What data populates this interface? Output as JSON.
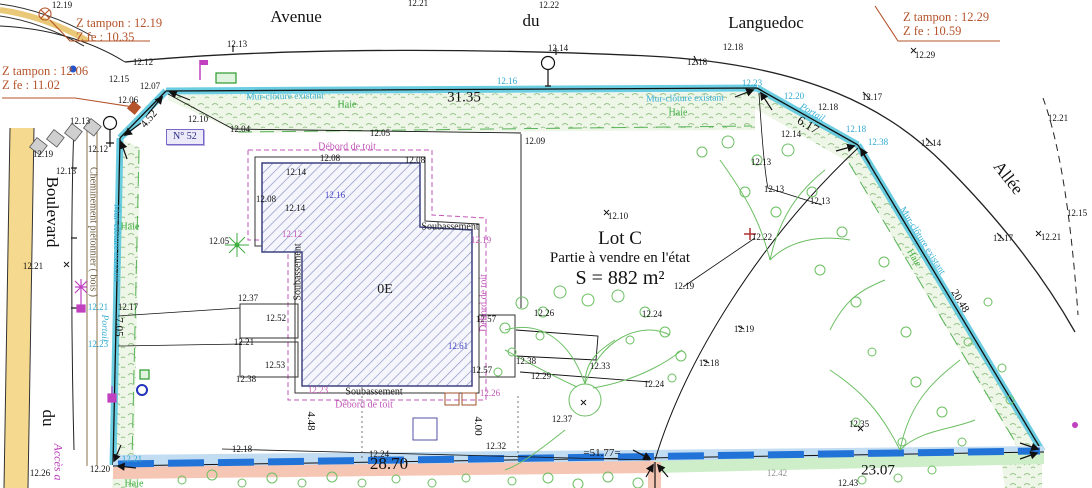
{
  "colors": {
    "boundary_cyan": "#4fc4dc",
    "hedge_green": "#57b357",
    "veg_green": "#6cbf63",
    "roof_magenta": "#c257b8",
    "note_orange": "#b5532a",
    "parcel_blue_dash": "#2273d8",
    "salmon_band": "#f6c6b4",
    "green_band": "#cdeec8",
    "hatch_blue": "#3c4280",
    "walk_tan": "#f0d080"
  },
  "z_notes": [
    {
      "line1": "Z tampon : 12.19",
      "line2": "Z fe : 10.35"
    },
    {
      "line1": "Z tampon : 12.06",
      "line2": "Z fe : 11.02"
    },
    {
      "line1": "Z tampon : 12.29",
      "line2": "Z fe : 10.59"
    }
  ],
  "streets": {
    "avenue": "Avenue",
    "du_top": "du",
    "languedoc": "Languedoc",
    "boulevard": "Boulevard",
    "du_left": "du",
    "allee": "Allée",
    "acces": "Accès a"
  },
  "lot": {
    "name": "Lot C",
    "desc": "Partie à vendre en l'état",
    "area": "S = 882 m²",
    "floor": "0E",
    "house_no": "N° 52"
  },
  "labels": [
    {
      "t": "12.19",
      "x": 62,
      "y": 5,
      "c": "spot"
    },
    {
      "t": "12.21",
      "x": 418,
      "y": 3,
      "c": "spot"
    },
    {
      "t": "12.22",
      "x": 549,
      "y": 5,
      "c": "spot"
    },
    {
      "t": "12.29",
      "x": 925,
      "y": 55,
      "c": "spot"
    },
    {
      "t": "12.13",
      "x": 237,
      "y": 44,
      "c": "spot"
    },
    {
      "t": "12.14",
      "x": 558,
      "y": 48,
      "c": "spot"
    },
    {
      "t": "12.18",
      "x": 733,
      "y": 47,
      "c": "spot"
    },
    {
      "t": "12.18",
      "x": 697,
      "y": 62,
      "c": "spot"
    },
    {
      "t": "12.17",
      "x": 872,
      "y": 97,
      "c": "spot"
    },
    {
      "t": "12.12",
      "x": 143,
      "y": 62,
      "c": "spot"
    },
    {
      "t": "12.15",
      "x": 119,
      "y": 79,
      "c": "spot"
    },
    {
      "t": "12.07",
      "x": 150,
      "y": 86,
      "c": "spot"
    },
    {
      "t": "12.06",
      "x": 128,
      "y": 100,
      "c": "spot"
    },
    {
      "t": "12.13",
      "x": 80,
      "y": 121,
      "c": "spot"
    },
    {
      "t": "12.12",
      "x": 98,
      "y": 149,
      "c": "spot"
    },
    {
      "t": "12.19",
      "x": 43,
      "y": 154,
      "c": "spot"
    },
    {
      "t": "12.13",
      "x": 66,
      "y": 171,
      "c": "spot"
    },
    {
      "t": "12.10",
      "x": 198,
      "y": 119,
      "c": "spot"
    },
    {
      "t": "12.04",
      "x": 240,
      "y": 129,
      "c": "spot"
    },
    {
      "t": "12.05",
      "x": 380,
      "y": 133,
      "c": "spot"
    },
    {
      "t": "12.09",
      "x": 535,
      "y": 141,
      "c": "spot"
    },
    {
      "t": "12.16",
      "x": 507,
      "y": 81,
      "c": "spot-cyan"
    },
    {
      "t": "12.23",
      "x": 752,
      "y": 83,
      "c": "spot-cyan"
    },
    {
      "t": "12.20",
      "x": 794,
      "y": 96,
      "c": "spot-cyan"
    },
    {
      "t": "12.18",
      "x": 828,
      "y": 107,
      "c": "spot"
    },
    {
      "t": "12.14",
      "x": 791,
      "y": 134,
      "c": "spot"
    },
    {
      "t": "12.13",
      "x": 761,
      "y": 162,
      "c": "spot"
    },
    {
      "t": "12.13",
      "x": 774,
      "y": 189,
      "c": "spot"
    },
    {
      "t": "12.13",
      "x": 820,
      "y": 201,
      "c": "spot"
    },
    {
      "t": "12.18",
      "x": 856,
      "y": 129,
      "c": "spot-cyan"
    },
    {
      "t": "12.38",
      "x": 878,
      "y": 142,
      "c": "spot-cyan"
    },
    {
      "t": "12.14",
      "x": 931,
      "y": 143,
      "c": "spot"
    },
    {
      "t": "12.21",
      "x": 1058,
      "y": 118,
      "c": "spot"
    },
    {
      "t": "12.17",
      "x": 1003,
      "y": 238,
      "c": "spot"
    },
    {
      "t": "12.15",
      "x": 1077,
      "y": 213,
      "c": "spot"
    },
    {
      "t": "12.21",
      "x": 1051,
      "y": 237,
      "c": "spot"
    },
    {
      "t": "12.21",
      "x": 33,
      "y": 266,
      "c": "spot"
    },
    {
      "t": "12.21",
      "x": 98,
      "y": 307,
      "c": "spot-cyan"
    },
    {
      "t": "12.17",
      "x": 128,
      "y": 307,
      "c": "spot"
    },
    {
      "t": "12.23",
      "x": 98,
      "y": 344,
      "c": "spot-cyan"
    },
    {
      "t": "12.08",
      "x": 266,
      "y": 199,
      "c": "spot"
    },
    {
      "t": "12.05",
      "x": 219,
      "y": 241,
      "c": "spot"
    },
    {
      "t": "12.14",
      "x": 296,
      "y": 172,
      "c": "spot"
    },
    {
      "t": "12.16",
      "x": 335,
      "y": 195,
      "c": "spot-blue"
    },
    {
      "t": "12.14",
      "x": 295,
      "y": 208,
      "c": "spot"
    },
    {
      "t": "12.12",
      "x": 292,
      "y": 234,
      "c": "spot-magenta"
    },
    {
      "t": "12.19",
      "x": 481,
      "y": 240,
      "c": "spot-magenta"
    },
    {
      "t": "12.10",
      "x": 618,
      "y": 216,
      "c": "spot"
    },
    {
      "t": "12.22",
      "x": 762,
      "y": 237,
      "c": "spot"
    },
    {
      "t": "12.19",
      "x": 684,
      "y": 286,
      "c": "spot"
    },
    {
      "t": "12.26",
      "x": 544,
      "y": 313,
      "c": "spot"
    },
    {
      "t": "12.24",
      "x": 652,
      "y": 314,
      "c": "spot"
    },
    {
      "t": "12.37",
      "x": 248,
      "y": 298,
      "c": "spot"
    },
    {
      "t": "12.52",
      "x": 276,
      "y": 318,
      "c": "spot"
    },
    {
      "t": "12.21",
      "x": 244,
      "y": 342,
      "c": "spot"
    },
    {
      "t": "12.53",
      "x": 275,
      "y": 365,
      "c": "spot"
    },
    {
      "t": "12.38",
      "x": 246,
      "y": 379,
      "c": "spot"
    },
    {
      "t": "12.57",
      "x": 486,
      "y": 319,
      "c": "spot"
    },
    {
      "t": "12.61",
      "x": 458,
      "y": 346,
      "c": "spot-blue"
    },
    {
      "t": "12.57",
      "x": 482,
      "y": 370,
      "c": "spot"
    },
    {
      "t": "12.23",
      "x": 318,
      "y": 390,
      "c": "spot-magenta"
    },
    {
      "t": "12.26",
      "x": 490,
      "y": 393,
      "c": "spot-magenta"
    },
    {
      "t": "12.38",
      "x": 526,
      "y": 361,
      "c": "spot"
    },
    {
      "t": "12.33",
      "x": 600,
      "y": 366,
      "c": "spot"
    },
    {
      "t": "12.29",
      "x": 541,
      "y": 376,
      "c": "spot"
    },
    {
      "t": "12.24",
      "x": 654,
      "y": 384,
      "c": "spot"
    },
    {
      "t": "12.37",
      "x": 562,
      "y": 419,
      "c": "spot"
    },
    {
      "t": "12.19",
      "x": 744,
      "y": 329,
      "c": "spot"
    },
    {
      "t": "12.18",
      "x": 709,
      "y": 363,
      "c": "spot"
    },
    {
      "t": "12.35",
      "x": 859,
      "y": 424,
      "c": "spot"
    },
    {
      "t": "12.43",
      "x": 848,
      "y": 483,
      "c": "spot"
    },
    {
      "t": "12.18",
      "x": 242,
      "y": 449,
      "c": "spot"
    },
    {
      "t": "12.24",
      "x": 379,
      "y": 454,
      "c": "spot"
    },
    {
      "t": "12.32",
      "x": 496,
      "y": 446,
      "c": "spot"
    },
    {
      "t": "12.26",
      "x": 40,
      "y": 473,
      "c": "spot"
    },
    {
      "t": "12.20",
      "x": 100,
      "y": 469,
      "c": "spot"
    },
    {
      "t": "12.21",
      "x": 132,
      "y": 459,
      "c": "spot-cyan"
    },
    {
      "t": "12.42",
      "x": 777,
      "y": 473,
      "c": "spot-gray"
    },
    {
      "t": "12.08",
      "x": 330,
      "y": 158,
      "c": "spot"
    },
    {
      "t": "12.08",
      "x": 415,
      "y": 160,
      "c": "spot"
    },
    {
      "t": "31.35",
      "x": 464,
      "y": 98,
      "c": "dim-lg"
    },
    {
      "t": "28.70",
      "x": 389,
      "y": 464,
      "c": "dim-xl"
    },
    {
      "t": "23.07",
      "x": 878,
      "y": 471,
      "c": "dim-lg"
    },
    {
      "t": "=51.77=",
      "x": 602,
      "y": 453,
      "c": "dim"
    },
    {
      "t": "6.17",
      "x": 808,
      "y": 125,
      "r": 31,
      "c": "dim-md"
    },
    {
      "t": "4.52",
      "x": 149,
      "y": 119,
      "r": -50,
      "c": "dim"
    },
    {
      "t": "7.05",
      "x": 119,
      "y": 327,
      "r": 90,
      "c": "dim"
    },
    {
      "t": "20.48",
      "x": 960,
      "y": 301,
      "r": 59,
      "c": "dim"
    },
    {
      "t": "4.48",
      "x": 311,
      "y": 421,
      "r": 90,
      "c": "dim"
    },
    {
      "t": "4.00",
      "x": 478,
      "y": 426,
      "r": 90,
      "c": "dim"
    },
    {
      "t": "Mur-clôture existant",
      "x": 285,
      "y": 97,
      "r": -1,
      "c": "feat-cyan"
    },
    {
      "t": "Haie",
      "x": 347,
      "y": 105,
      "c": "feat-green"
    },
    {
      "t": "Mur-clôture existant",
      "x": 685,
      "y": 99,
      "r": -1,
      "c": "feat-cyan"
    },
    {
      "t": "Haie",
      "x": 678,
      "y": 113,
      "c": "feat-green"
    },
    {
      "t": "Mur-clôture existant",
      "x": 116,
      "y": 243,
      "r": 90,
      "c": "feat-cyan"
    },
    {
      "t": "Haie",
      "x": 130,
      "y": 227,
      "c": "feat-green"
    },
    {
      "t": "Mur-clôture existant",
      "x": 922,
      "y": 241,
      "r": 58,
      "c": "feat-cyan"
    },
    {
      "t": "Haie",
      "x": 914,
      "y": 258,
      "r": 58,
      "c": "feat-green"
    },
    {
      "t": "Haie",
      "x": 134,
      "y": 484,
      "c": "feat-green"
    },
    {
      "t": "Portail",
      "x": 812,
      "y": 113,
      "r": 30,
      "c": "feat-portail"
    },
    {
      "t": "Portail",
      "x": 104,
      "y": 328,
      "r": 90,
      "c": "feat-portail"
    },
    {
      "t": "Cheminement piétonnier ( bois )",
      "x": 93,
      "y": 232,
      "r": 90,
      "c": "feat-path"
    },
    {
      "t": "Débord de toit",
      "x": 347,
      "y": 147,
      "c": "feat-magenta"
    },
    {
      "t": "Débord de toit",
      "x": 484,
      "y": 303,
      "r": -90,
      "c": "feat-magenta"
    },
    {
      "t": "Débord de toit",
      "x": 364,
      "y": 405,
      "c": "feat-magenta"
    },
    {
      "t": "Soubassement",
      "x": 298,
      "y": 272,
      "r": -90,
      "c": "feat-black"
    },
    {
      "t": "Soubassement",
      "x": 450,
      "y": 227,
      "c": "feat-black"
    },
    {
      "t": "Soubassement",
      "x": 374,
      "y": 392,
      "c": "feat-black"
    }
  ]
}
